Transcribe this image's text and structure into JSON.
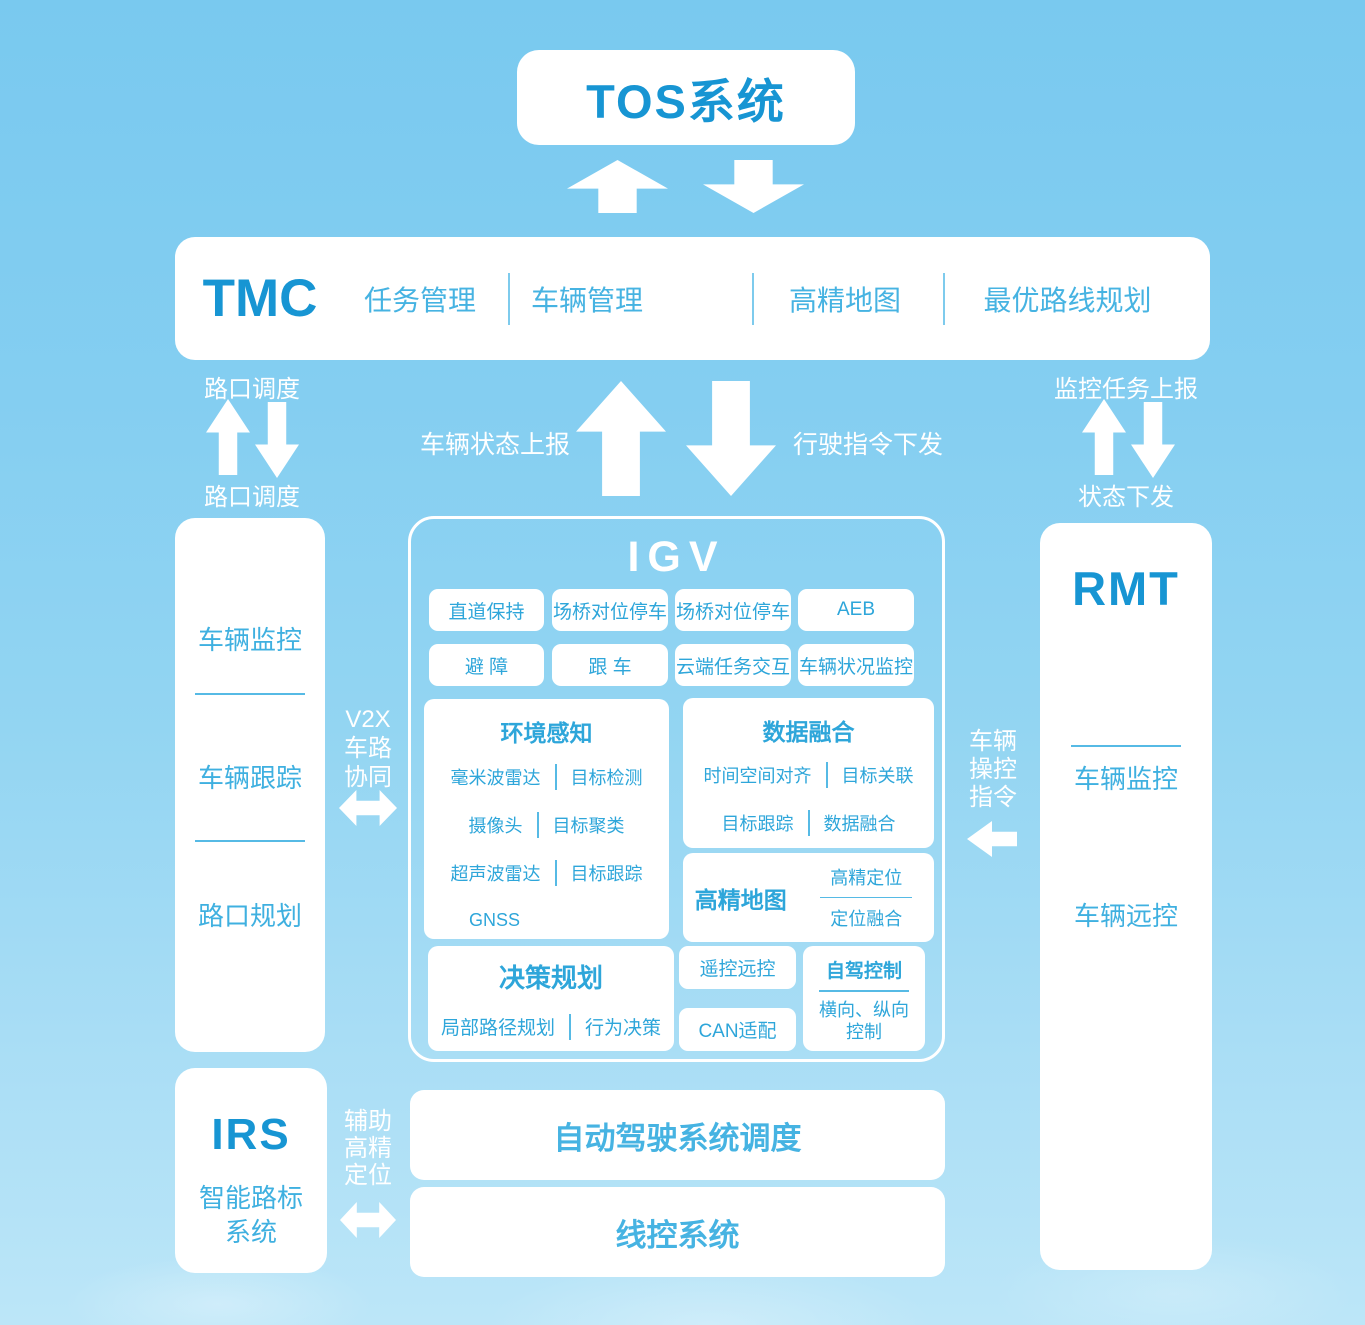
{
  "palette": {
    "background_top": "#79c9ef",
    "background_bottom": "#bce6f8",
    "panel": "#ffffff",
    "title_blue": "#1795d3",
    "text_blue": "#3badde"
  },
  "tos": {
    "title": "TOS系统"
  },
  "tmc": {
    "title": "TMC",
    "items": [
      "任务管理",
      "车辆管理",
      "高精地图",
      "最优路线规划"
    ]
  },
  "flows": {
    "junction_top": "路口调度",
    "junction_bottom": "路口调度",
    "vehicle_status_up": "车辆状态上报",
    "drive_cmd_down": "行驶指令下发",
    "monitor_task_up": "监控任务上报",
    "status_down": "状态下发",
    "v2x_lines": [
      "V2X",
      "车路",
      "协同"
    ],
    "vehicle_ctrl_lines": [
      "车辆",
      "操控",
      "指令"
    ],
    "aux_pos_lines": [
      "辅助",
      "高精",
      "定位"
    ]
  },
  "left_panel": {
    "items": [
      "车辆监控",
      "车辆跟踪",
      "路口规划"
    ]
  },
  "igv": {
    "title": "IGV",
    "feature_rows": [
      [
        "直道保持",
        "场桥对位停车",
        "场桥对位停车",
        "AEB"
      ],
      [
        "避 障",
        "跟 车",
        "云端任务交互",
        "车辆状况监控"
      ]
    ],
    "perception": {
      "title": "环境感知",
      "pairs": [
        [
          "毫米波雷达",
          "目标检测"
        ],
        [
          "摄像头",
          "目标聚类"
        ],
        [
          "超声波雷达",
          "目标跟踪"
        ]
      ],
      "single": "GNSS"
    },
    "fusion": {
      "title": "数据融合",
      "pairs": [
        [
          "时间空间对齐",
          "目标关联"
        ],
        [
          "目标跟踪",
          "数据融合"
        ]
      ]
    },
    "hdmap": {
      "title": "高精地图",
      "items": [
        "高精定位",
        "定位融合"
      ]
    },
    "planning": {
      "title": "决策规划",
      "pair": [
        "局部路径规划",
        "行为决策"
      ]
    },
    "remote_label": "遥控远控",
    "can_label": "CAN适配",
    "selfdrive": {
      "title": "自驾控制",
      "lines": [
        "横向、纵向",
        "控制"
      ]
    }
  },
  "rmt": {
    "title": "RMT",
    "items": [
      "车辆监控",
      "车辆远控"
    ]
  },
  "irs": {
    "title": "IRS",
    "subtitle_lines": [
      "智能路标",
      "系统"
    ]
  },
  "bottom": {
    "bars": [
      "自动驾驶系统调度",
      "线控系统"
    ]
  }
}
